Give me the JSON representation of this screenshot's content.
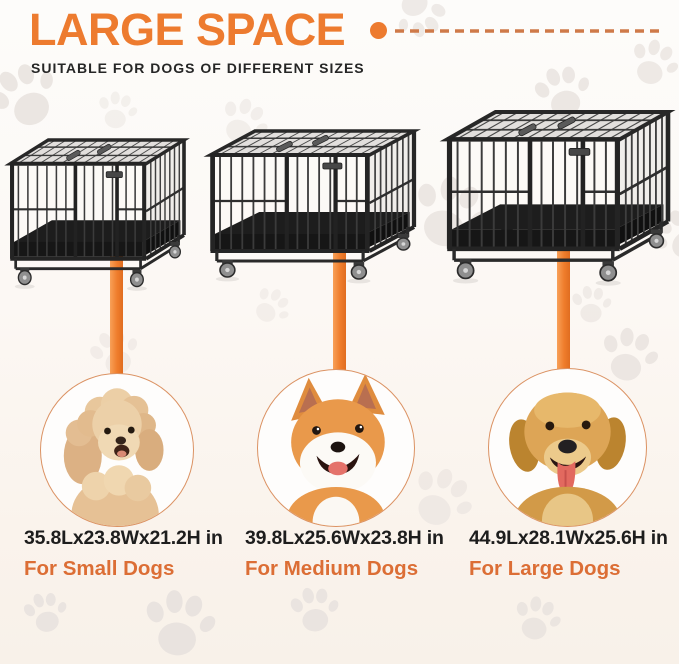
{
  "header": {
    "title": "LARGE SPACE",
    "subtitle": "SUITABLE FOR DOGS OF DIFFERENT SIZES",
    "divider_icon": "dot-dashed-line"
  },
  "decor": {
    "watermark_icon": "paw-print-icon",
    "crate_illustration": "metal-dog-crate-with-wheels"
  },
  "colors": {
    "accent": "#ED7B2F",
    "accent_text": "#DC6E35",
    "dash": "#CF7A49",
    "text_dark": "#1D1D1D",
    "circle_ring": "#DB9263",
    "paw_watermark": "#E9E3DF",
    "cage_metal": "#2B2B2B"
  },
  "crates": [
    {
      "size": "small",
      "dog_breed": "poodle",
      "dimensions": "35.8Lx23.8Wx21.2H in",
      "label": "For Small Dogs"
    },
    {
      "size": "medium",
      "dog_breed": "shiba-inu",
      "dimensions": "39.8Lx25.6Wx23.8H in",
      "label": "For Medium Dogs"
    },
    {
      "size": "large",
      "dog_breed": "golden-retriever",
      "dimensions": "44.9Lx28.1Wx25.6H in",
      "label": "For Large Dogs"
    }
  ]
}
